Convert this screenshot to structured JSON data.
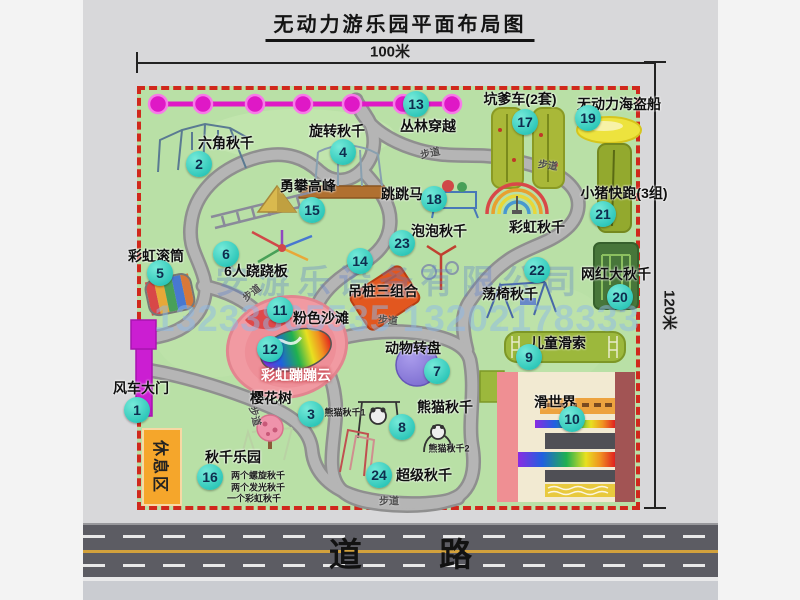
{
  "title": "无动力游乐园平面布局图",
  "dim_width": "100米",
  "dim_height": "120米",
  "road": {
    "label": "道 路"
  },
  "watermark": {
    "company": "安游乐设备有限公司",
    "phones": "13233805535 13202178333"
  },
  "zones": {
    "rest_area": "休息区"
  },
  "path_label_text": "步道",
  "attractions": [
    {
      "num": "1",
      "label": "风车大门",
      "badge": {
        "x": 137,
        "y": 410
      },
      "text": {
        "x": 141,
        "y": 388
      }
    },
    {
      "num": "2",
      "label": "六角秋千",
      "badge": {
        "x": 199,
        "y": 164
      },
      "text": {
        "x": 226,
        "y": 143
      }
    },
    {
      "num": "3",
      "label": "樱花树",
      "badge": {
        "x": 311,
        "y": 414
      },
      "text": {
        "x": 271,
        "y": 398
      }
    },
    {
      "num": "4",
      "label": "旋转秋千",
      "badge": {
        "x": 343,
        "y": 152
      },
      "text": {
        "x": 337,
        "y": 131
      }
    },
    {
      "num": "5",
      "label": "彩虹滚筒",
      "badge": {
        "x": 160,
        "y": 273
      },
      "text": {
        "x": 156,
        "y": 256
      }
    },
    {
      "num": "6",
      "label": "6人跷跷板",
      "badge": {
        "x": 226,
        "y": 254
      },
      "text": {
        "x": 256,
        "y": 271
      }
    },
    {
      "num": "7",
      "label": "动物转盘",
      "badge": {
        "x": 437,
        "y": 371
      },
      "text": {
        "x": 413,
        "y": 348
      }
    },
    {
      "num": "8",
      "label": "熊猫秋千",
      "badge": {
        "x": 402,
        "y": 427
      },
      "text": {
        "x": 445,
        "y": 407
      }
    },
    {
      "num": "9",
      "label": "儿童滑索",
      "badge": {
        "x": 529,
        "y": 357
      },
      "text": {
        "x": 558,
        "y": 343
      }
    },
    {
      "num": "10",
      "label": "滑世界",
      "badge": {
        "x": 572,
        "y": 419
      },
      "text": {
        "x": 555,
        "y": 402
      }
    },
    {
      "num": "11",
      "label": "粉色沙滩",
      "badge": {
        "x": 280,
        "y": 310
      },
      "text": {
        "x": 321,
        "y": 318
      }
    },
    {
      "num": "12",
      "label": "彩虹蹦蹦云",
      "badge": {
        "x": 270,
        "y": 349
      },
      "text": {
        "x": 296,
        "y": 375
      },
      "light": true
    },
    {
      "num": "13",
      "label": "丛林穿越",
      "badge": {
        "x": 416,
        "y": 104
      },
      "text": {
        "x": 428,
        "y": 126
      }
    },
    {
      "num": "14",
      "label": "吊桩三组合",
      "badge": {
        "x": 360,
        "y": 261
      },
      "text": {
        "x": 383,
        "y": 291
      }
    },
    {
      "num": "15",
      "label": "勇攀高峰",
      "badge": {
        "x": 312,
        "y": 210
      },
      "text": {
        "x": 308,
        "y": 186
      }
    },
    {
      "num": "16",
      "label": "秋千乐园",
      "badge": {
        "x": 210,
        "y": 477
      },
      "text": {
        "x": 233,
        "y": 457
      }
    },
    {
      "num": "17",
      "label": "坑爹车(2套)",
      "badge": {
        "x": 525,
        "y": 122
      },
      "text": {
        "x": 520,
        "y": 99
      }
    },
    {
      "num": "18",
      "label": "跳跳马",
      "badge": {
        "x": 434,
        "y": 199
      },
      "text": {
        "x": 402,
        "y": 194
      }
    },
    {
      "num": "19",
      "label": "无动力海盗船",
      "badge": {
        "x": 588,
        "y": 118
      },
      "text": {
        "x": 619,
        "y": 104
      }
    },
    {
      "num": "20",
      "label": "网红大秋千",
      "badge": {
        "x": 620,
        "y": 297
      },
      "text": {
        "x": 616,
        "y": 274
      }
    },
    {
      "num": "21",
      "label": "小猪快跑(3组)",
      "badge": {
        "x": 603,
        "y": 214
      },
      "text": {
        "x": 624,
        "y": 193
      }
    },
    {
      "num": "22",
      "label": "荡椅秋千",
      "badge": {
        "x": 537,
        "y": 270
      },
      "text": {
        "x": 510,
        "y": 294
      }
    },
    {
      "num": "23",
      "label": "泡泡秋千",
      "badge": {
        "x": 402,
        "y": 243
      },
      "text": {
        "x": 439,
        "y": 231
      }
    },
    {
      "num": "24",
      "label": "超级秋千",
      "badge": {
        "x": 379,
        "y": 475
      },
      "text": {
        "x": 424,
        "y": 475
      }
    }
  ],
  "extra_labels": [
    {
      "text": "彩虹秋千",
      "x": 537,
      "y": 227
    }
  ],
  "notes": [
    {
      "text": "熊猫秋千1",
      "x": 345,
      "y": 412
    },
    {
      "text": "熊猫秋千2",
      "x": 449,
      "y": 448
    },
    {
      "text": "两个螺旋秋千",
      "x": 258,
      "y": 475
    },
    {
      "text": "两个发光秋千",
      "x": 258,
      "y": 487
    },
    {
      "text": "一个彩虹秋千",
      "x": 254,
      "y": 498
    }
  ],
  "path_labels": [
    {
      "x": 251,
      "y": 292,
      "rot": -38
    },
    {
      "x": 430,
      "y": 152,
      "rot": -12
    },
    {
      "x": 548,
      "y": 164,
      "rot": 8
    },
    {
      "x": 388,
      "y": 319,
      "rot": 5
    },
    {
      "x": 256,
      "y": 416,
      "rot": 75
    },
    {
      "x": 389,
      "y": 500,
      "rot": 0
    }
  ],
  "colors": {
    "badge": "#2cc6b8",
    "map_green": "#b9e0a6",
    "border_red": "#d0281c",
    "zipline_magenta": "#df18c6",
    "gate_magenta": "#cb1ed2",
    "rest_area_orange": "#f5a62b"
  }
}
